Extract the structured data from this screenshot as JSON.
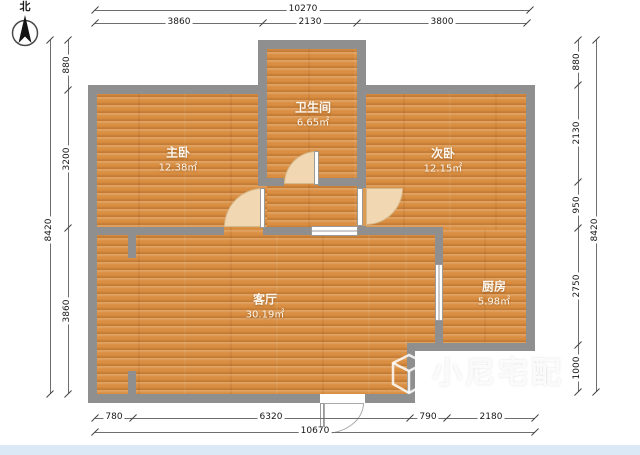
{
  "meta": {
    "north_label": "北"
  },
  "rooms": {
    "master": {
      "name": "主卧",
      "area": "12.38㎡"
    },
    "bathroom": {
      "name": "卫生间",
      "area": "6.65㎡"
    },
    "secondary": {
      "name": "次卧",
      "area": "12.15㎡"
    },
    "living": {
      "name": "客厅",
      "area": "30.19㎡"
    },
    "kitchen": {
      "name": "厨房",
      "area": "5.98㎡"
    }
  },
  "dimensions": {
    "top": {
      "total": "10270",
      "segments": [
        "3860",
        "2130",
        "3800"
      ]
    },
    "bottom": {
      "total": "10670",
      "segments": [
        "780",
        "6320",
        "790",
        "2180"
      ]
    },
    "left": {
      "total": "8420",
      "segments": [
        "880",
        "3200",
        "3860"
      ]
    },
    "right": {
      "total": "8420",
      "segments": [
        "880",
        "2130",
        "950",
        "2750",
        "1000"
      ]
    }
  },
  "watermark": {
    "brand": "小尼宅配"
  },
  "colors": {
    "floor": "#d98e41",
    "wall": "#8f8f8f",
    "door_fan": "#f2d8b2",
    "footer": "#dbe9f6"
  }
}
